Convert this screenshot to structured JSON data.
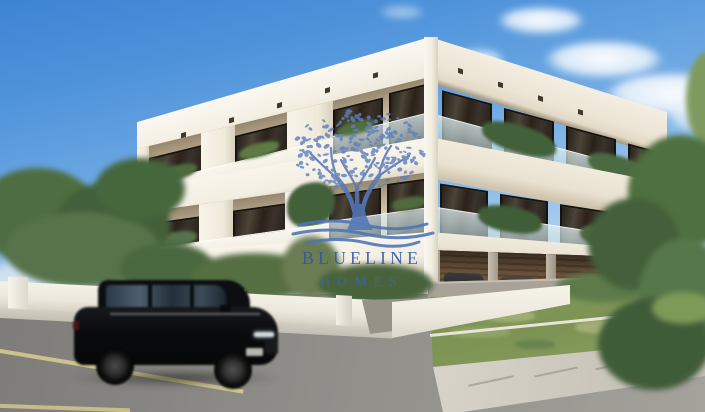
{
  "watermark": {
    "line1": "BLUELINE",
    "line2": "HOMES",
    "logo": "olive-tree-over-waves",
    "text_color": "#2d57a8",
    "logo_color": "#5b7fbe"
  },
  "scene": {
    "type": "architectural-exterior-render",
    "description": "Photorealistic render of a modern white two-storey apartment building with recessed balconies, glass railings and planted terraces; covered parking bays with timber-slat walls and parked cars at ground level; a black SUV with motion blur drives past on the asphalt road; white garden walls, green lawn and concrete sidewalk in the foreground; dense green trees at left and right under a blue sky with scattered clouds; blue BLUELINE HOMES olive-tree watermark in the centre",
    "palette": {
      "sky_top": "#3d84d4",
      "sky_horizon": "#e2eef8",
      "building_white": "#f5f0e5",
      "recessed_wall": "#cebfa5",
      "window_glass": "#2b2119",
      "timber_slats": "#86694c",
      "lawn_green": "#7f9657",
      "road_asphalt": "#8b8a86",
      "sidewalk": "#cdc9bf",
      "suv_black": "#0b0c0e",
      "road_marking": "#d6c98f"
    },
    "objects": [
      "sky",
      "clouds",
      "apartment-building",
      "balconies",
      "glass-railings",
      "planters",
      "covered-parking",
      "parked-cars",
      "black-suv",
      "asphalt-road",
      "road-markings",
      "sidewalk",
      "lawn",
      "garden-walls",
      "driveway",
      "trees",
      "shrubs"
    ]
  }
}
